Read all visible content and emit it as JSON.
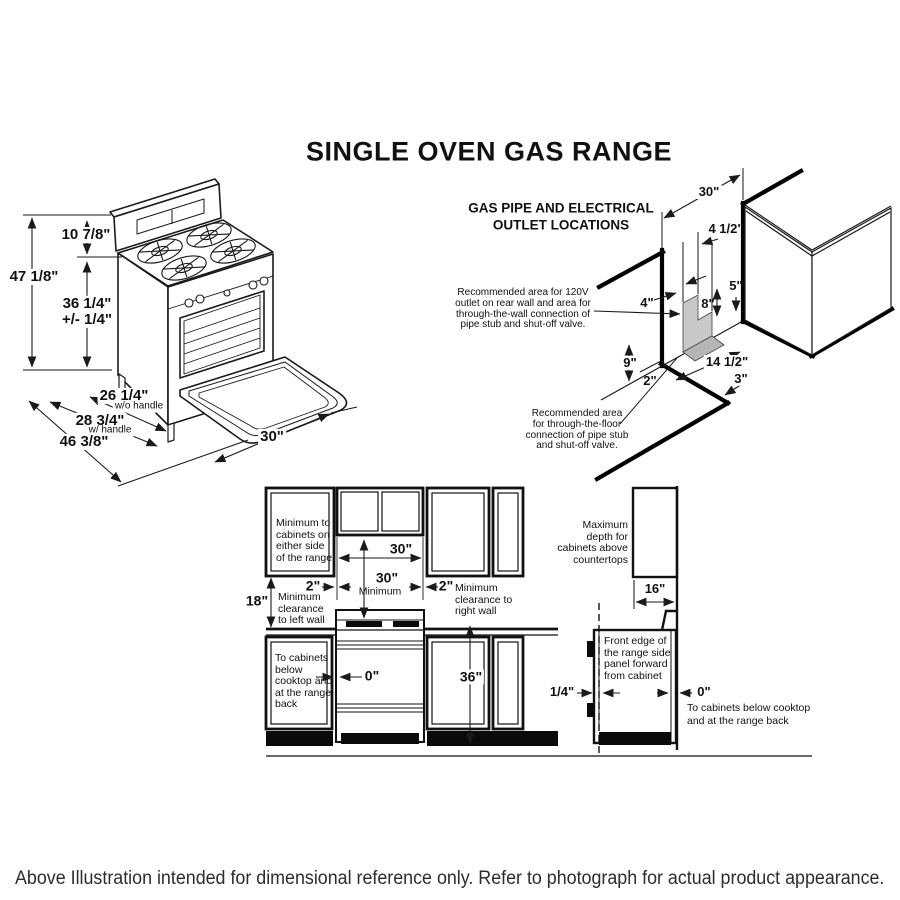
{
  "title": "SINGLE OVEN GAS RANGE",
  "caption": "Above Illustration intended for dimensional reference only. Refer to photograph for actual product appearance.",
  "colors": {
    "line": "#1a1a1a",
    "shaded_wall_area": "#c8c8c8",
    "shaded_floor_area": "#b5b5b5"
  },
  "range_view": {
    "height_overall": "47 1/8\"",
    "height_backsplash": "10 7/8\"",
    "height_cooktop": "36 1/4\"\n+/- 1/4\"",
    "depth_no_handle": "26 1/4\"",
    "depth_no_handle_note": "w/o handle",
    "depth_handle": "28 3/4\"",
    "depth_handle_note": "w/ handle",
    "depth_door_open": "46 3/8\"",
    "width": "30\""
  },
  "gas_view": {
    "heading": "GAS PIPE AND ELECTRICAL\nOUTLET LOCATIONS",
    "dims": {
      "rear_wall_width": "30\"",
      "outlet_right": "4 1/2\"",
      "outlet_top": "5\"",
      "outlet_left": "4\"",
      "outlet_height": "8\"",
      "floor_left": "9\"",
      "floor_gap": "2\"",
      "floor_width": "14 1/2\"",
      "floor_depth": "3\""
    },
    "note_wall": "Recommended area for 120V\noutlet on rear wall and area for\nthrough-the-wall connection of\npipe stub and shut-off valve.",
    "note_floor": "Recommended area\nfor through-the-floor\nconnection of pipe stub\nand shut-off valve."
  },
  "clearance_view": {
    "cab_width": "30\"",
    "min_vert": "30\"",
    "min_vert_note": "Minimum",
    "side_left": "2\"",
    "side_right": "2\"",
    "wall_left": "18\"",
    "note_sides": "Minimum to\ncabinets on\neither side\nof the range.",
    "note_left_wall": "Minimum\nclearance\nto left wall",
    "note_right_wall": "Minimum\nclearance to\nright wall",
    "note_below": "To cabinets\nbelow\ncooktop and\nat the range\nback",
    "zero_front": "0\"",
    "counter_height": "36\"",
    "note_max_depth": "Maximum\ndepth for\ncabinets above\ncountertops",
    "cab_depth": "16\"",
    "note_front_edge": "Front edge of\nthe range side\npanel forward\nfrom cabinet",
    "quarter": "1/4\"",
    "zero_side": "0\"",
    "note_below_side": "To cabinets below cooktop\nand at the range back"
  }
}
